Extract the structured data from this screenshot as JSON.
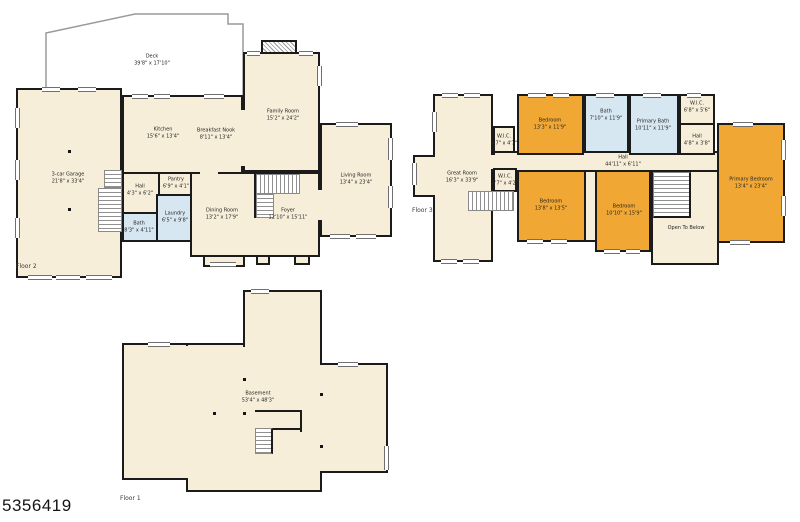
{
  "photo_id": "5356419",
  "colors": {
    "room_fill": "#f7eed9",
    "bedroom_fill": "#f0a734",
    "bath_fill": "#d7e7f2",
    "wall": "#1b1b1b"
  },
  "plans": [
    {
      "floor_label": "Floor 2",
      "rooms": [
        {
          "name": "Deck",
          "dims": "39'8\" x 17'10\""
        },
        {
          "name": "3-car Garage",
          "dims": "21'8\" x 33'4\""
        },
        {
          "name": "Kitchen",
          "dims": "15'6\" x 13'4\""
        },
        {
          "name": "Breakfast Nook",
          "dims": "8'11\" x 13'4\""
        },
        {
          "name": "Family Room",
          "dims": "15'2\" x 24'2\""
        },
        {
          "name": "Living Room",
          "dims": "13'4\" x 23'4\""
        },
        {
          "name": "Hall",
          "dims": "4'3\" x 6'2\""
        },
        {
          "name": "Pantry",
          "dims": "6'9\" x 4'1\""
        },
        {
          "name": "Bath",
          "dims": "8'3\" x 4'11\""
        },
        {
          "name": "Laundry",
          "dims": "6'5\" x 9'8\""
        },
        {
          "name": "Dining Room",
          "dims": "13'2\" x 17'9\""
        },
        {
          "name": "Foyer",
          "dims": "12'10\" x 15'11\""
        }
      ]
    },
    {
      "floor_label": "Floor 3",
      "rooms": [
        {
          "name": "Great Room",
          "dims": "16'3\" x 33'9\""
        },
        {
          "name": "W.I.C.",
          "dims": "4'7\" x 4'7\""
        },
        {
          "name": "W.I.C.",
          "dims": "4'7\" x 4'2\""
        },
        {
          "name": "Bedroom",
          "dims": "13'3\" x 11'9\""
        },
        {
          "name": "Bath",
          "dims": "7'10\" x 11'9\""
        },
        {
          "name": "Primary Bath",
          "dims": "10'11\" x 11'9\""
        },
        {
          "name": "W.I.C.",
          "dims": "6'8\" x 5'6\""
        },
        {
          "name": "Hall",
          "dims": "4'8\" x 3'8\""
        },
        {
          "name": "Hall",
          "dims": "44'11\" x 6'11\""
        },
        {
          "name": "Bedroom",
          "dims": "13'8\" x 13'5\""
        },
        {
          "name": "Bedroom",
          "dims": "10'10\" x 15'9\""
        },
        {
          "name": "Open To Below",
          "dims": ""
        },
        {
          "name": "Primary Bedroom",
          "dims": "13'4\" x 23'4\""
        }
      ]
    },
    {
      "floor_label": "Floor 1",
      "rooms": [
        {
          "name": "Basement",
          "dims": "53'4\" x 48'3\""
        }
      ]
    }
  ]
}
